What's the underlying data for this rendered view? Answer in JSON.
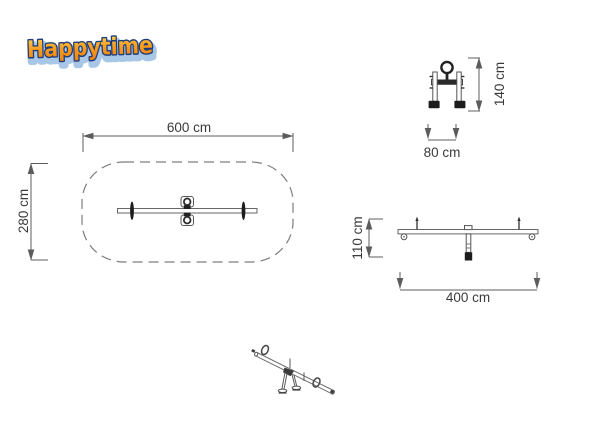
{
  "logo": {
    "text": "Happytime"
  },
  "colors": {
    "logo_yellow": "#ffd24f",
    "logo_orange": "#f89b1c",
    "logo_deep_orange": "#ee7f10",
    "logo_outline": "#1e3c78",
    "logo_glow": "#a8c6e6",
    "line": "#6e6e6e",
    "dark_fill": "#1c1c1c",
    "label_text": "#3a3a3a"
  },
  "views": {
    "plan": {
      "width_label": "600 cm",
      "depth_label": "280 cm"
    },
    "front": {
      "height_label": "140 cm",
      "width_label": "80 cm"
    },
    "side": {
      "height_label": "110 cm",
      "length_label": "400 cm"
    }
  }
}
